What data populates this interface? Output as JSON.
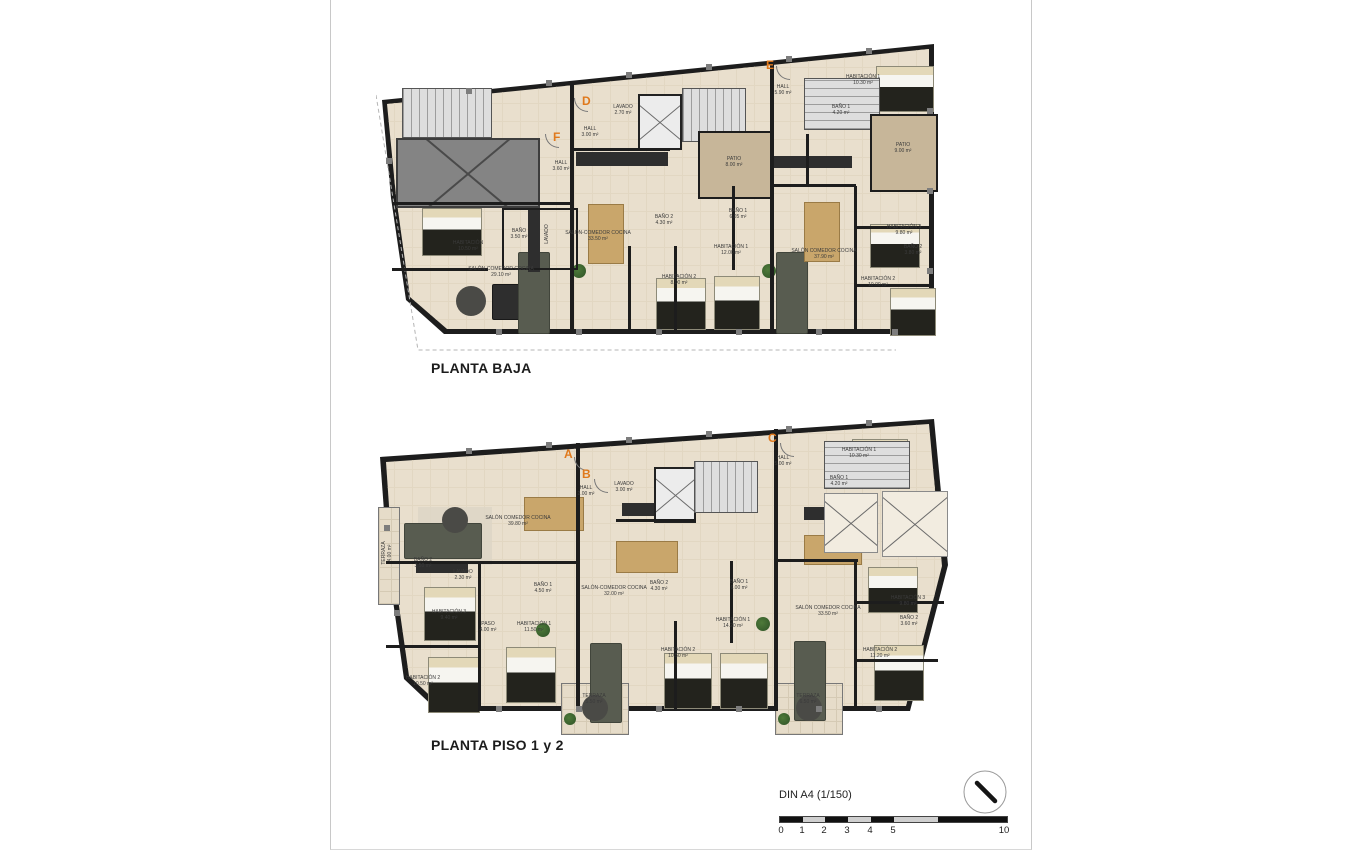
{
  "document": {
    "scale_label": "DIN A4 (1/150)",
    "scale_ticks": [
      "0",
      "1",
      "2",
      "3",
      "4",
      "5",
      "10"
    ],
    "accent_orange": "#e0791c",
    "floor_beige": "#e9dfcd",
    "wall_color": "#1d1d1d"
  },
  "plan_baja": {
    "title": "PLANTA BAJA",
    "unit_letters": [
      "D",
      "F",
      "E"
    ],
    "rooms": [
      {
        "label": "HABITACIÓN",
        "area": "10.50 m²"
      },
      {
        "label": "BAÑO",
        "area": "3.50 m²"
      },
      {
        "label": "LAVADO",
        "area": ""
      },
      {
        "label": "SALÓN-COMEDOR COCINA",
        "area": "29.10 m²"
      },
      {
        "label": "HALL",
        "area": "3.60 m²"
      },
      {
        "label": "LAVADO",
        "area": "2.70 m²"
      },
      {
        "label": "HALL",
        "area": "3.00 m²"
      },
      {
        "label": "SALÓN-COMEDOR COCINA",
        "area": "33.50 m²"
      },
      {
        "label": "PATIO",
        "area": "8.00 m²"
      },
      {
        "label": "BAÑO 2",
        "area": "4.30 m²"
      },
      {
        "label": "BAÑO 1",
        "area": "6.05 m²"
      },
      {
        "label": "HABITACIÓN 1",
        "area": "12.00 m²"
      },
      {
        "label": "HABITACIÓN 2",
        "area": "8.00 m²"
      },
      {
        "label": "HALL",
        "area": "5.90 m²"
      },
      {
        "label": "HABITACIÓN 1",
        "area": "10.30 m²"
      },
      {
        "label": "BAÑO 1",
        "area": "4.20 m²"
      },
      {
        "label": "PATIO",
        "area": "9.00 m²"
      },
      {
        "label": "SALÓN COMEDOR COCINA",
        "area": "37.90 m²"
      },
      {
        "label": "HABITACIÓN 3",
        "area": "9.80 m²"
      },
      {
        "label": "BAÑO 2",
        "area": "3.80 m²"
      },
      {
        "label": "HABITACIÓN 2",
        "area": "10.00 m²"
      }
    ]
  },
  "plan_piso": {
    "title": "PLANTA PISO 1 y 2",
    "unit_letters": [
      "A",
      "B",
      "C"
    ],
    "rooms": [
      {
        "label": "TERRAZA",
        "area": "4.00 m²"
      },
      {
        "label": "SALÓN COMEDOR COCINA",
        "area": "39.80 m²"
      },
      {
        "label": "BAÑO 2",
        "area": "3.50 m²"
      },
      {
        "label": "LAVADO",
        "area": "2.30 m²"
      },
      {
        "label": "HABITACIÓN 3",
        "area": "9.40 m²"
      },
      {
        "label": "PASO",
        "area": "4.00 m²"
      },
      {
        "label": "BAÑO 1",
        "area": "4.50 m²"
      },
      {
        "label": "HABITACIÓN 1",
        "area": "11.50 m²"
      },
      {
        "label": "HABITACIÓN 2",
        "area": "10.50 m²"
      },
      {
        "label": "HALL",
        "area": "2.00 m²"
      },
      {
        "label": "LAVADO",
        "area": "3.00 m²"
      },
      {
        "label": "SALÓN-COMEDOR COCINA",
        "area": "32.00 m²"
      },
      {
        "label": "BAÑO 2",
        "area": "4.30 m²"
      },
      {
        "label": "BAÑO 1",
        "area": "6.00 m²"
      },
      {
        "label": "HABITACIÓN 1",
        "area": "14.20 m²"
      },
      {
        "label": "HABITACIÓN 2",
        "area": "10.50 m²"
      },
      {
        "label": "TERRAZA",
        "area": "5.50 m²"
      },
      {
        "label": "HALL",
        "area": "5.00 m²"
      },
      {
        "label": "HABITACIÓN 1",
        "area": "10.30 m²"
      },
      {
        "label": "BAÑO 1",
        "area": "4.20 m²"
      },
      {
        "label": "SALÓN COMEDOR COCINA",
        "area": "33.50 m²"
      },
      {
        "label": "HABITACIÓN 3",
        "area": "9.80 m²"
      },
      {
        "label": "BAÑO 2",
        "area": "3.60 m²"
      },
      {
        "label": "HABITACIÓN 2",
        "area": "11.20 m²"
      },
      {
        "label": "TERRAZA",
        "area": "6.50 m²"
      }
    ]
  }
}
